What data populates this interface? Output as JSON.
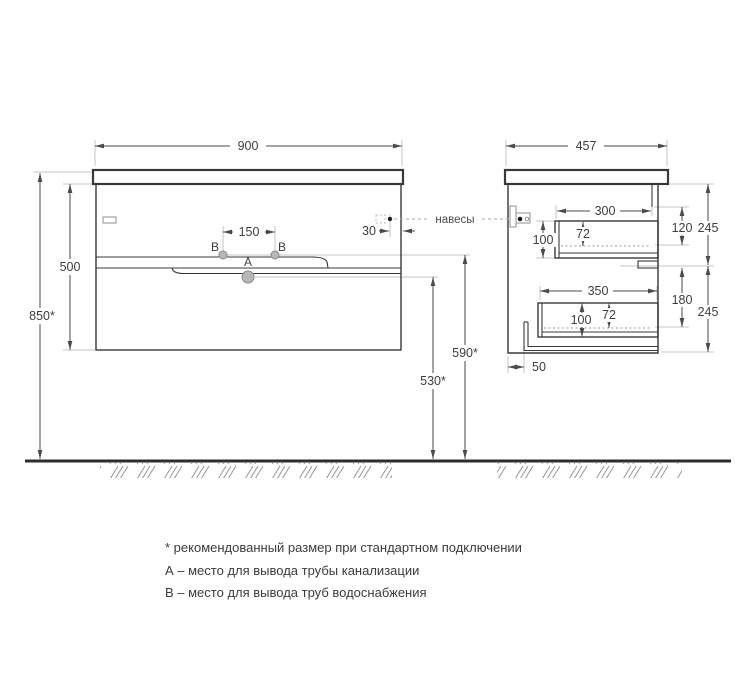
{
  "drawing": {
    "front_view": {
      "dim_width": "900",
      "dim_cabinet_height": "500",
      "dim_total_height": "850*",
      "dim_faucet_spacing": "150",
      "dim_hanger_offset": "30",
      "dim_water_supply_height": "590*",
      "dim_drain_height": "530*",
      "label_a": "А",
      "label_b_left": "В",
      "label_b_right": "В"
    },
    "side_view": {
      "dim_depth": "457",
      "dim_top_drawer_width": "300",
      "dim_top_drawer_height": "100",
      "dim_top_drawer_inner_height": "72",
      "dim_top_front_height": "120",
      "dim_top_section_height": "245",
      "dim_bottom_drawer_width": "350",
      "dim_bottom_drawer_height": "100",
      "dim_bottom_drawer_inner_height": "72",
      "dim_bottom_front_height": "180",
      "dim_bottom_section_height": "245",
      "dim_back_clearance": "50"
    },
    "hangers_label": "навесы",
    "notes": [
      "* рекомендованный размер при стандартном подключении",
      "А – место для вывода трубы канализации",
      "В – место для вывода труб водоснабжения"
    ]
  }
}
